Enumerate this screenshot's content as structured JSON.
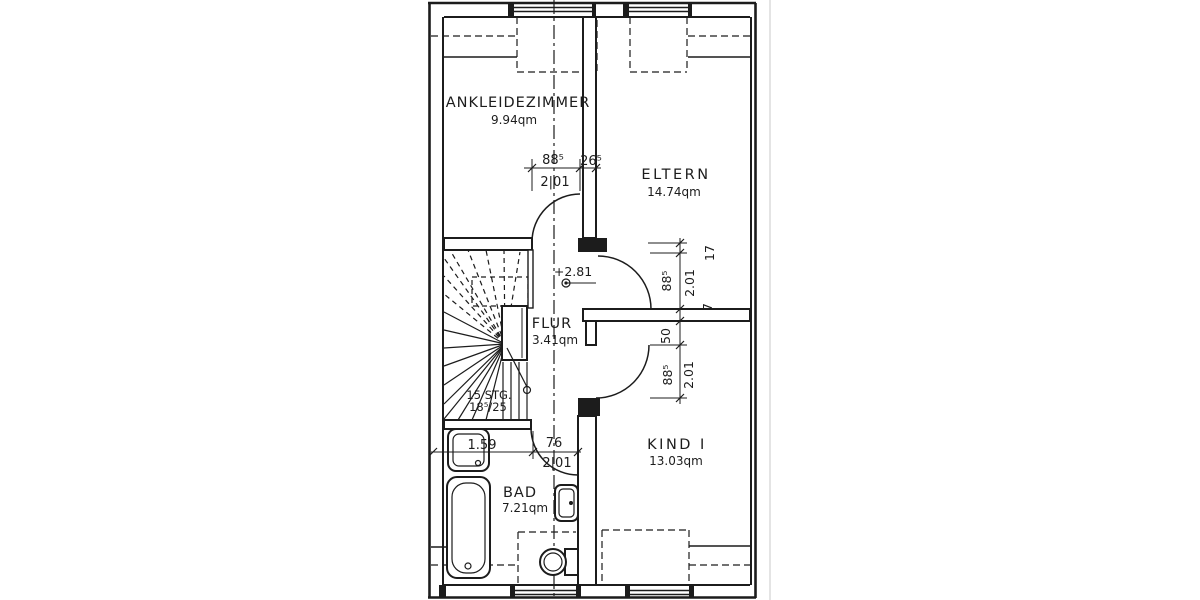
{
  "floor_plan": {
    "colors": {
      "ink": "#1c1c1c",
      "paper": "#ffffff"
    },
    "rooms": {
      "ankleidezimmer": {
        "name": "ANKLEIDEZIMMER",
        "area": "9.94qm"
      },
      "eltern": {
        "name": "ELTERN",
        "area": "14.74qm"
      },
      "flur": {
        "name": "FLUR",
        "area": "3.41qm"
      },
      "bad": {
        "name": "BAD",
        "area": "7.21qm"
      },
      "kind1": {
        "name": "KIND I",
        "area": "13.03qm"
      }
    },
    "staircase": {
      "steps_label": "15 STG.",
      "rise_run_label": "18⁵/25"
    },
    "level_marker_label": "+2.81",
    "dimensions": {
      "ankleide_door": {
        "width": "88⁵",
        "jamb_offset": "26⁵",
        "height": "2|01"
      },
      "bad": {
        "fixture_width": "1.59",
        "door_width": "76",
        "door_height": "2|01"
      },
      "right_chain": {
        "top_offset": "17",
        "eltern_door_width": "88⁵",
        "eltern_door_height": "2.01",
        "wall_offset": "7",
        "kind_offset": "50",
        "kind_door_width": "88⁵",
        "kind_door_height": "2.01"
      }
    }
  }
}
